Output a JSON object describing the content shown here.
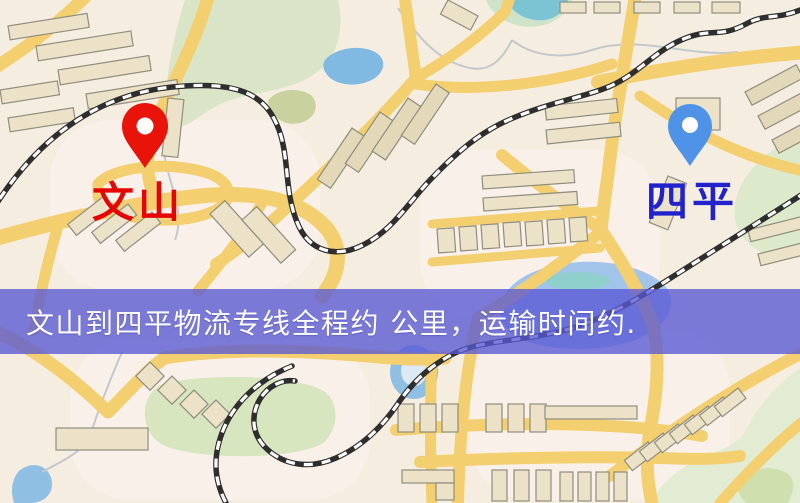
{
  "map": {
    "origin_label": "文山",
    "destination_label": "四平",
    "origin_label_color": "#e60505",
    "destination_label_color": "#2222cc",
    "origin_pin_color": "#e81309",
    "destination_pin_color": "#4f93e8",
    "road_color": "#f3cf70",
    "water_color": "#90bfe4",
    "park_color": "#d8e6c0"
  },
  "banner": {
    "text": "文山到四平物流专线全程约 公里，运输时间约.",
    "background_color": "#5858d4",
    "text_color": "#ffffff"
  }
}
